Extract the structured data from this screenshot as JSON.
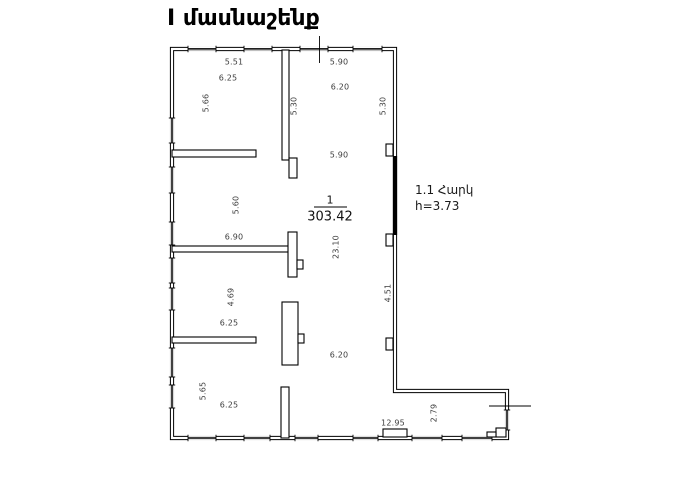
{
  "title": "I մասնաշենք",
  "floor_note": {
    "line1": "1.1 Հարկ",
    "line2": "h=3.73"
  },
  "room": {
    "number": "1",
    "area": "303.42"
  },
  "dims": {
    "room1_top": "5.51",
    "room1_width": "6.25",
    "room1_height": "5.66",
    "hall_top_width": "5.90",
    "hall_width_upper": "6.20",
    "hall_upper_height_left": "5.30",
    "hall_upper_height_right": "5.30",
    "hall_inner_width": "5.90",
    "room2_height": "5.60",
    "room2_width": "6.90",
    "hall_height": "23.10",
    "right_wall_height": "4.51",
    "room3_height": "4.69",
    "room3_width": "6.25",
    "hall_width_lower": "6.20",
    "room4_height": "5.65",
    "room4_width": "6.25",
    "bottom_width": "12.95",
    "wing_height": "2.79"
  }
}
